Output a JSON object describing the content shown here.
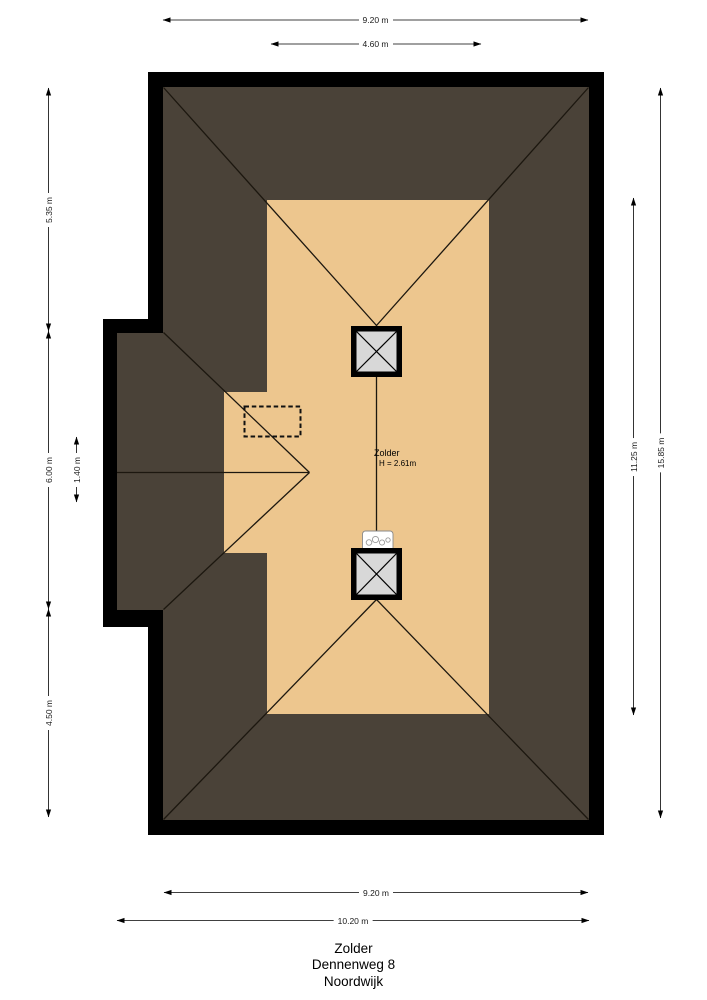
{
  "plan": {
    "type": "floorplan-top-view",
    "room": {
      "name": "Zolder",
      "height_label": "H = 2.61m"
    },
    "features": [
      "roof-surface",
      "attic-floor",
      "chimney-top",
      "chimney-bottom",
      "boiler-unit",
      "dashed-opening",
      "side-dormer"
    ]
  },
  "dimensions": {
    "top_width": "9.20 m",
    "top_inner_width": "4.60 m",
    "left_top": "5.35 m",
    "left_middle": "6.00 m",
    "left_small": "1.40 m",
    "left_bottom": "4.50 m",
    "right_inner": "11.25 m",
    "right_total": "15.85 m",
    "bottom_width": "9.20 m",
    "bottom_total_width": "10.20 m"
  },
  "title": {
    "line1": "Zolder",
    "line2": "Dennenweg 8",
    "line3": "Noordwijk"
  },
  "colors": {
    "wall": "#000000",
    "roof": "#4a4238",
    "floor": "#edc68e",
    "chimney_fill": "#d8d8d8",
    "line": "#1c170f",
    "dim_line": "#000000",
    "background": "#ffffff"
  }
}
